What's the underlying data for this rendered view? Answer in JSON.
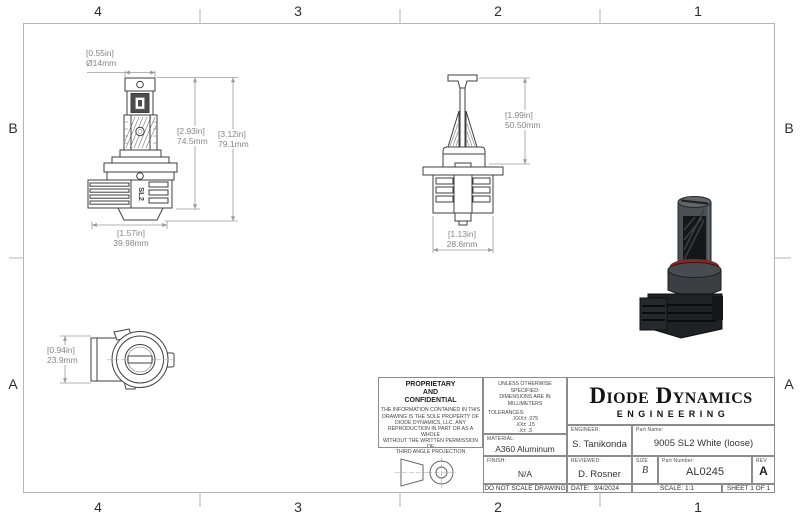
{
  "zones": {
    "top": [
      "4",
      "3",
      "2",
      "1"
    ],
    "bottom": [
      "4",
      "3",
      "2",
      "1"
    ],
    "left": [
      "B",
      "A"
    ],
    "right": [
      "B",
      "A"
    ]
  },
  "views": {
    "front": {
      "logo": "SL2",
      "dims": {
        "dia": {
          "in": "[0.55in]",
          "mm": "Ø14mm"
        },
        "h1": {
          "in": "[2.93in]",
          "mm": "74.5mm"
        },
        "h2": {
          "in": "[3.12in]",
          "mm": "79.1mm"
        },
        "width": {
          "in": "[1.57in]",
          "mm": "39.98mm"
        }
      }
    },
    "side": {
      "dims": {
        "height": {
          "in": "[1.99in]",
          "mm": "50.50mm"
        },
        "width": {
          "in": "[1.13in]",
          "mm": "28.6mm"
        }
      }
    },
    "top": {
      "dims": {
        "height": {
          "in": "[0.94in]",
          "mm": "23.9mm"
        }
      }
    }
  },
  "title_block": {
    "proprietary_title": "PROPRIETARY\nAND\nCONFIDENTIAL",
    "proprietary_body": "THE INFORMATION CONTAINED IN THIS\nDRAWING IS THE SOLE PROPERTY OF\nDIODE DYNAMICS, LLC.  ANY\nREPRODUCTION IN PART OR AS A WHOLE\nWITHOUT THE WRITTEN PERMISSION OF\nDIODE DYNAMICS, LLC. IS PROHIBITED.",
    "third_angle_label": "THIRD ANGLE PROJECTION",
    "spec_line1": "UNLESS OTHERWISE SPECIFIED:",
    "spec_line2": "DIMENSIONS ARE IN MILLIMETERS",
    "tolerances_label": "TOLERANCES:",
    "tolerances": [
      ".XXX± .075",
      ".XX± .15",
      ".X± .3",
      "X± .5",
      "ANG± 1"
    ],
    "material_label": "MATERIAL:",
    "material_value": "A360 Aluminum",
    "finish_label": "FINISH:",
    "finish_value": "N/A",
    "do_not_scale": "DO NOT SCALE DRAWING",
    "engineer_label": "ENGINEER:",
    "engineer_value": "S. Tanikonda",
    "reviewed_label": "REVIEWED:",
    "reviewed_value": "D. Rosner",
    "date_label": "DATE:",
    "date_value": "3/4/2024",
    "logo_name": "Diode Dynamics",
    "logo_sub": "ENGINEERING",
    "part_name_label": "Part Name:",
    "part_name_value": "9005 SL2 White (loose)",
    "size_label": "SIZE",
    "size_value": "B",
    "part_number_label": "Part Number:",
    "part_number_value": "AL0245",
    "rev_label": "REV",
    "rev_value": "A",
    "scale_text": "SCALE: 1:1",
    "sheet_text": "SHEET 1 OF 1"
  },
  "colors": {
    "line": "#3f3f3f",
    "dim_text": "#868686",
    "frame": "#b5b5b5",
    "tb_border": "#8c8c8c",
    "oring_red": "#8d2424",
    "logo_black": "#141414"
  }
}
